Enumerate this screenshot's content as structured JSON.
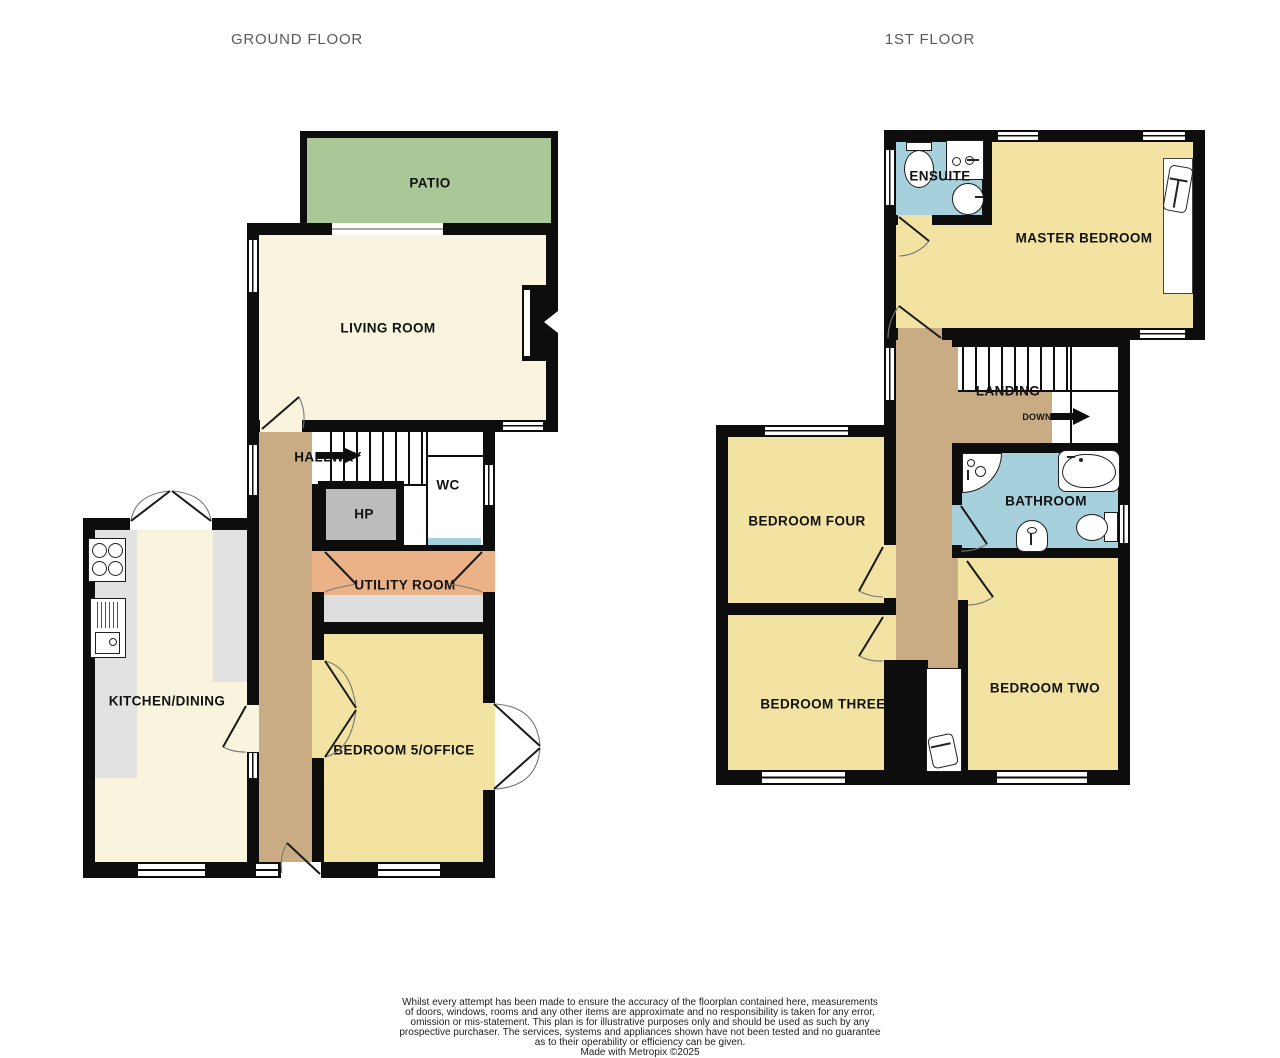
{
  "titles": {
    "ground": "GROUND FLOOR",
    "first": "1ST FLOOR"
  },
  "ground_floor": {
    "rooms": {
      "patio": "PATIO",
      "living_room": "LIVING ROOM",
      "hallway": "HALLWAY",
      "wc": "WC",
      "hp": "HP",
      "utility": "UTILITY ROOM",
      "kitchen": "KITCHEN/DINING",
      "bedroom5": "BEDROOM 5/OFFICE"
    }
  },
  "first_floor": {
    "rooms": {
      "ensuite": "ENSUITE",
      "master_bedroom": "MASTER BEDROOM",
      "landing": "LANDING",
      "down": "DOWN",
      "bedroom_four": "BEDROOM FOUR",
      "bathroom": "BATHROOM",
      "bedroom_three": "BEDROOM THREE",
      "bedroom_two": "BEDROOM TWO"
    }
  },
  "disclaimer": {
    "lines": [
      "Whilst every attempt has been made to ensure the accuracy of the floorplan contained here, measurements",
      "of doors, windows, rooms and any other items are approximate and no responsibility is taken for any error,",
      "omission or mis-statement. This plan is for illustrative purposes only and should be used as such by any",
      "prospective purchaser. The services, systems and appliances shown have not been tested and no guarantee",
      "as to their operability or efficiency can be given."
    ],
    "credit": "Made with Metropix ©2025"
  },
  "colors": {
    "wall": "#0d0d0d",
    "patio": "#a9c797",
    "cream": "#f8f4dd",
    "yellow": "#f2e3a2",
    "brown": "#c9ac84",
    "salmon": "#eab286",
    "blue": "#a6d0dc",
    "hp_gray": "#bcbcbc",
    "counter_gray": "#e2e2e2",
    "utility_counter": "#dedede",
    "title": "#5b5b5b"
  }
}
